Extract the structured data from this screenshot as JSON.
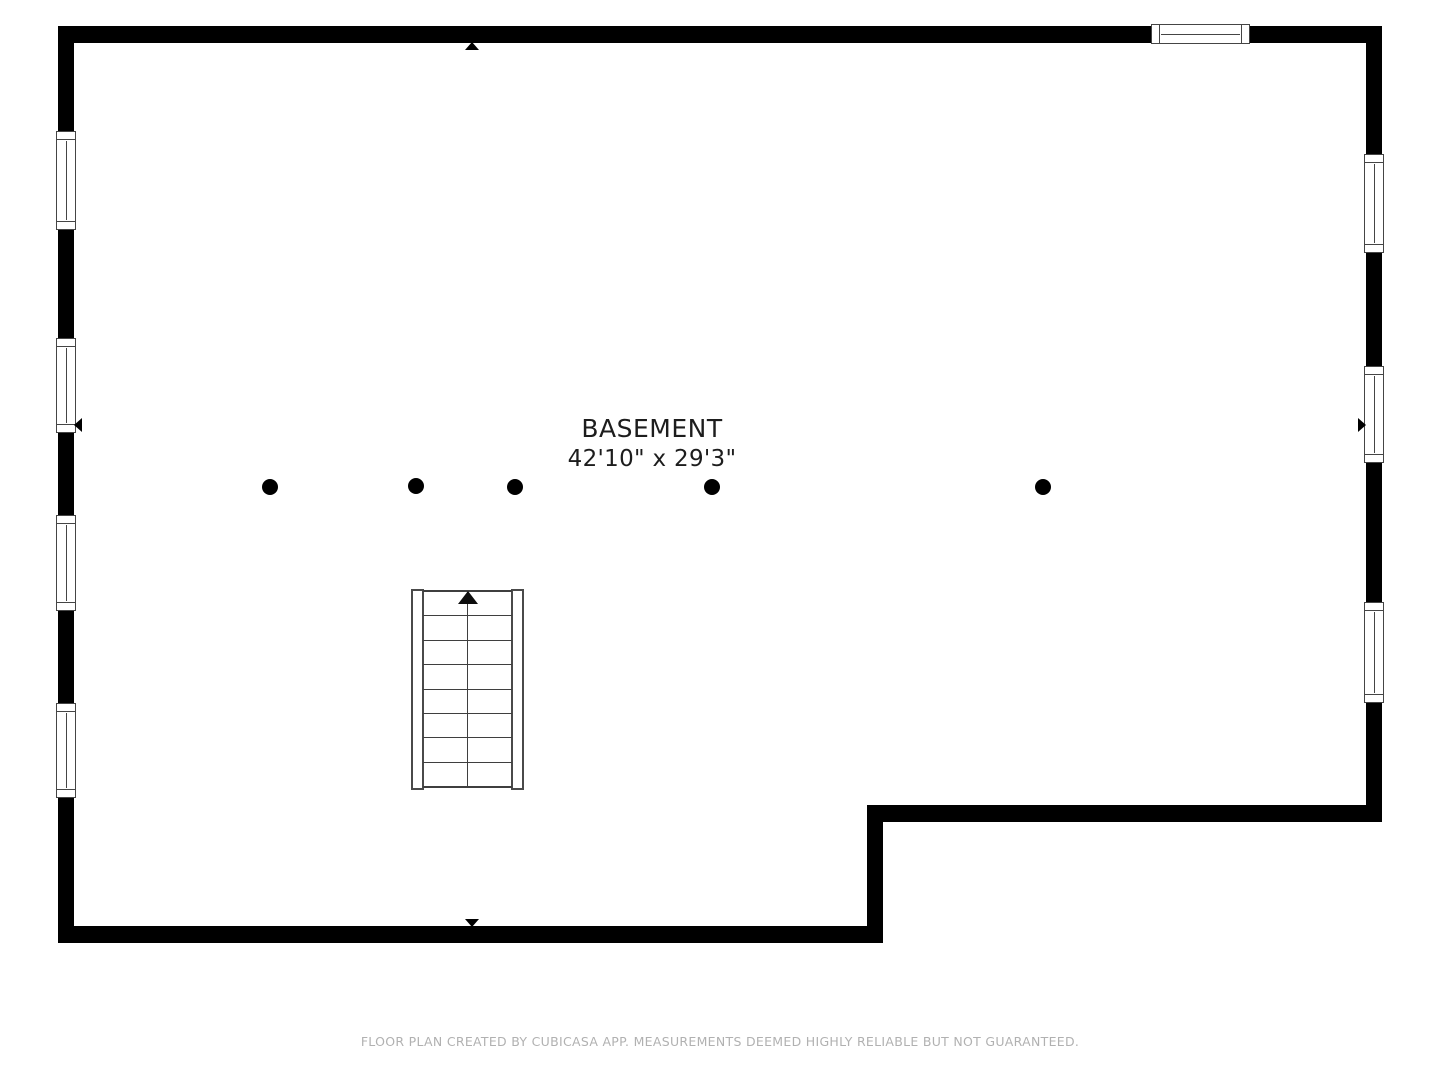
{
  "room": {
    "label": "BASEMENT",
    "dimensions": "42'10\" x 29'3\""
  },
  "footer": {
    "text": "FLOOR PLAN CREATED BY CUBICASA APP. MEASUREMENTS DEEMED HIGHLY RELIABLE BUT NOT GUARANTEED."
  },
  "colors": {
    "wall": "#000000",
    "fixture_line": "#454545",
    "label_text": "#1d1d1d",
    "footer_text": "#b1b1b1",
    "background": "#ffffff"
  },
  "plan": {
    "floor_name": "Basement",
    "support_columns_count": 5,
    "windows_count": 8,
    "staircase": {
      "steps_count": 8,
      "direction": "up",
      "direction_icon": "up-arrow-icon"
    },
    "wall_markers": [
      "up-arrow-icon",
      "down-arrow-icon",
      "left-arrow-icon",
      "right-arrow-icon"
    ]
  }
}
